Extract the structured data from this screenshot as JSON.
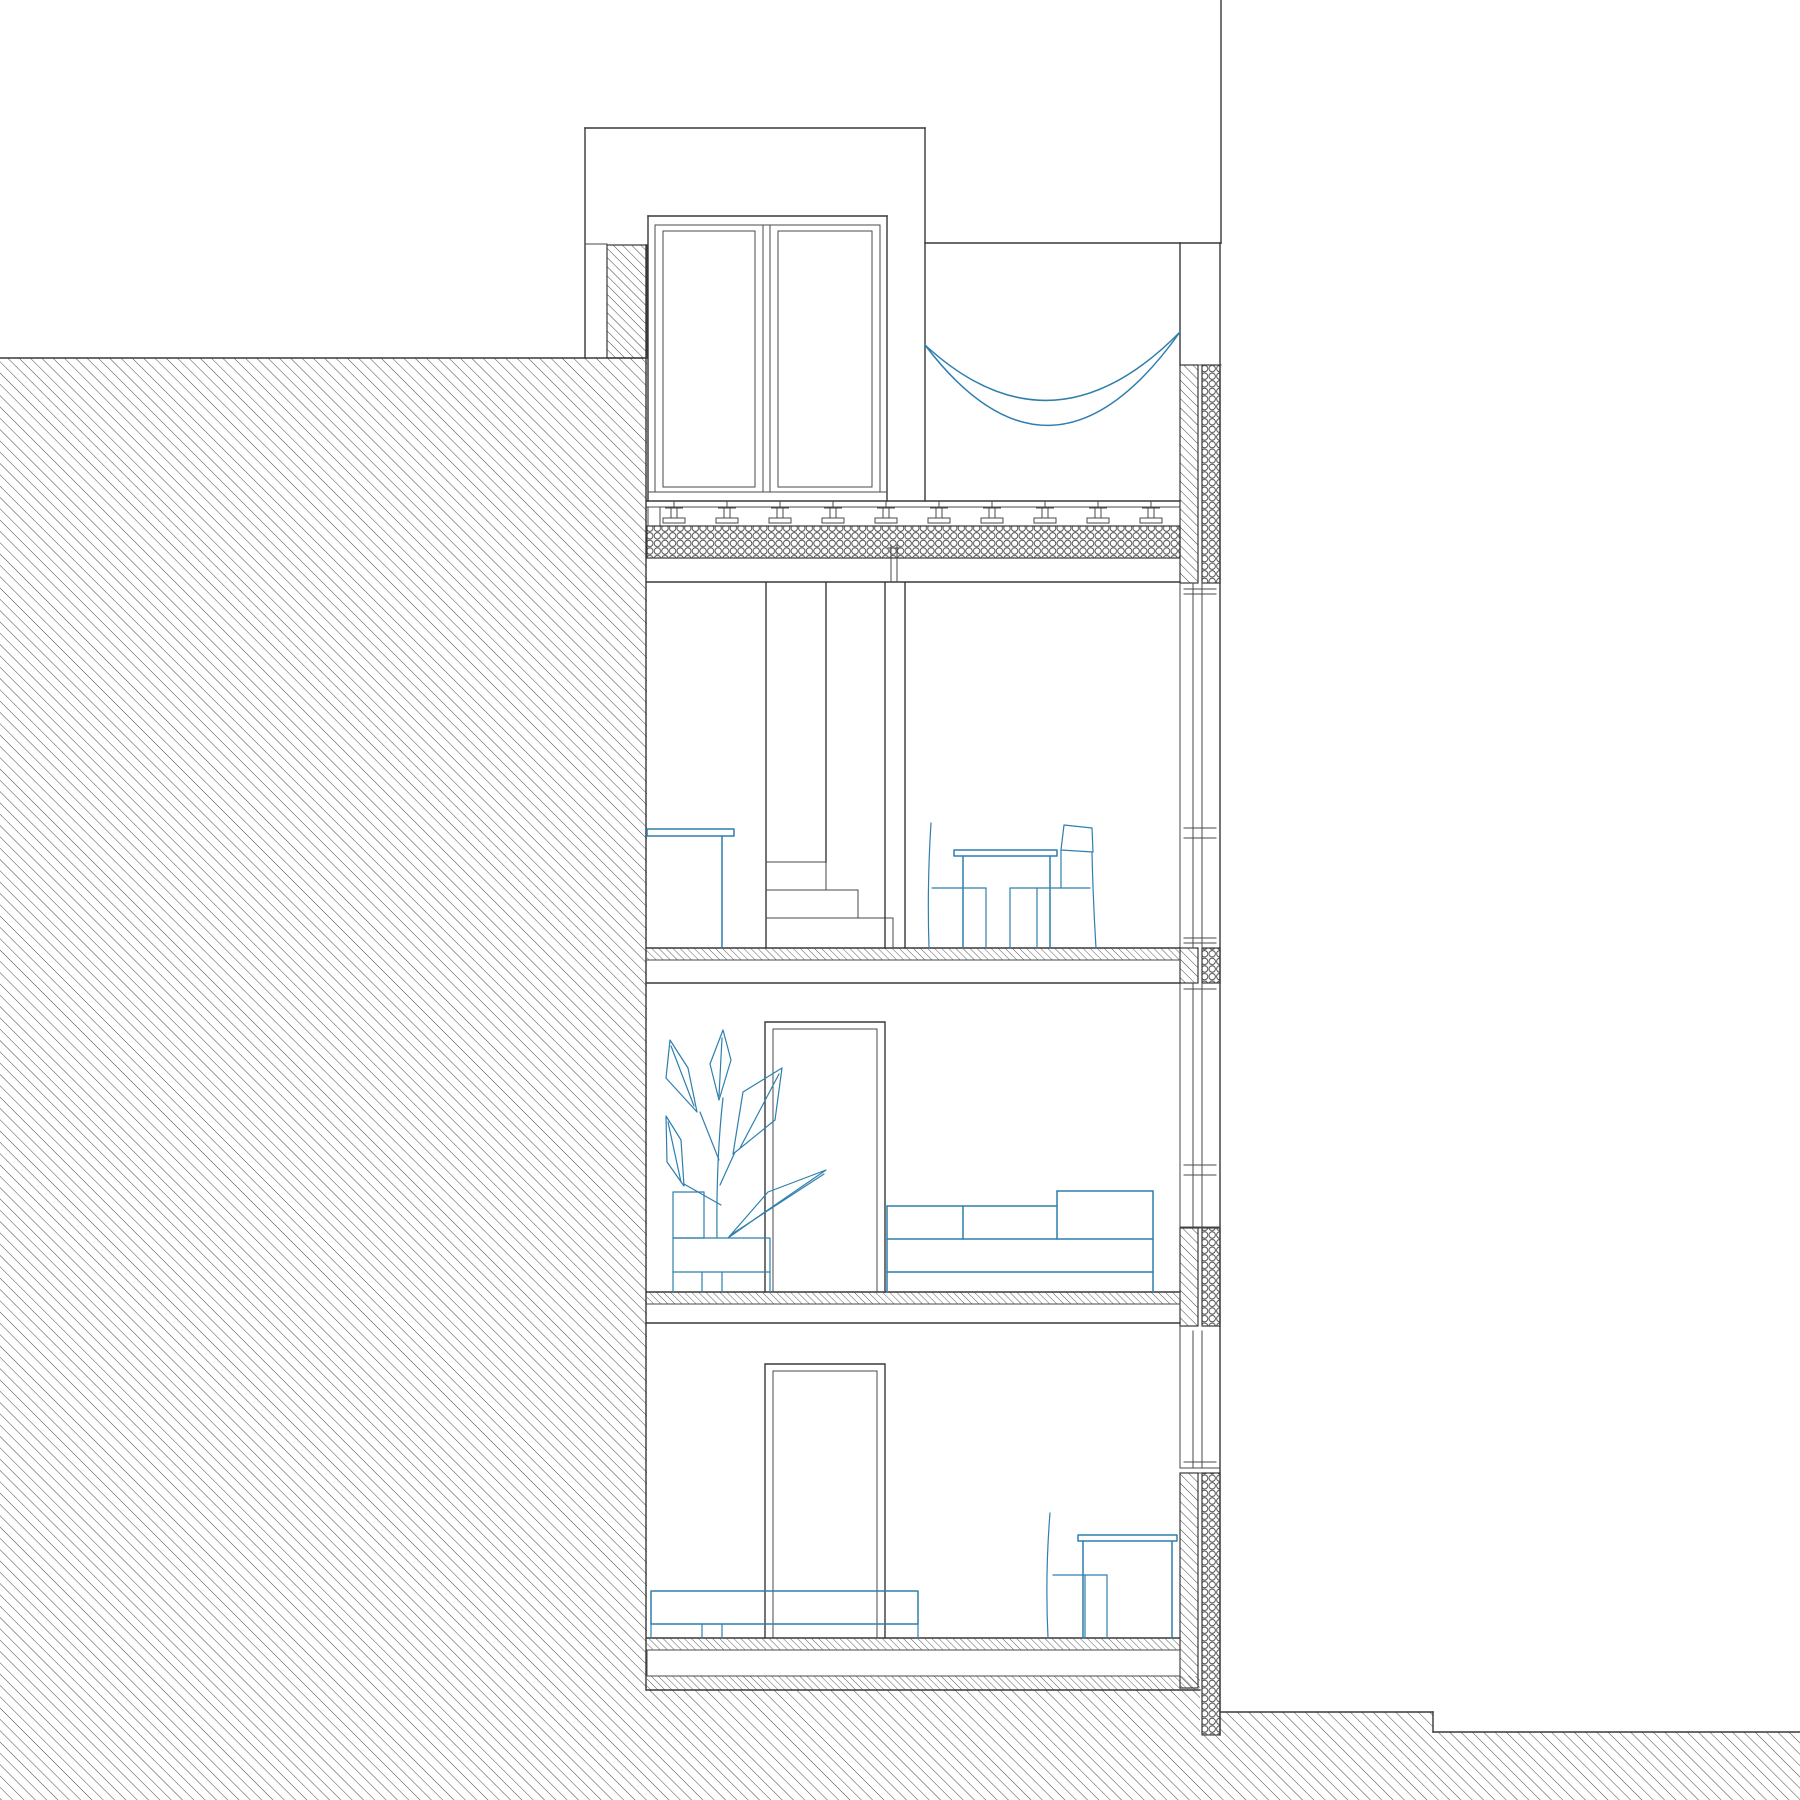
{
  "drawing": {
    "aria": "Architectural building cross-section with hillside at left, roof terrace and three floor levels",
    "type": "building section",
    "background_color": "#ffffff",
    "line_color": "#383838",
    "furniture_color": "#2e7fae",
    "site": {
      "left": "earth embankment, diagonal section hatch, top at upper third",
      "right": "lower street level with one step down near right edge",
      "under_building": "continuous earth hatch below bottom slab"
    },
    "levels": [
      {
        "name": "roof-terrace",
        "items": [
          "penthouse volume",
          "double glass door",
          "hammock",
          "paver deck on pedestals",
          "honeycomb insulation layer",
          "hatched parapet walls"
        ]
      },
      {
        "name": "upper-floor",
        "items": [
          "wall-mounted desk",
          "staircase with partition wall",
          "dining table",
          "two chairs",
          "full-height window at right"
        ]
      },
      {
        "name": "middle-floor",
        "items": [
          "potted plant",
          "interior door",
          "three-seat sofa",
          "window with spandrel below"
        ]
      },
      {
        "name": "lower-floor",
        "items": [
          "long sideboard",
          "interior door",
          "chair",
          "work desk",
          "small window with deep spandrel"
        ]
      }
    ],
    "patterns": {
      "earth": "45deg thin diagonal hatch, ~8px pitch",
      "cut_wall": "45deg diagonal hatch, ~6px pitch",
      "floor_finish": "45deg fine hatch, ~5px pitch",
      "insulation": "tangent circle honeycomb"
    }
  }
}
